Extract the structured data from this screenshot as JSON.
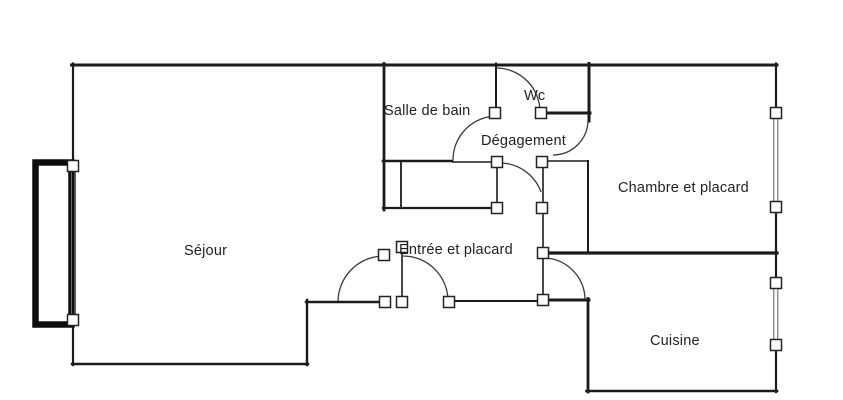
{
  "floorplan": {
    "type_label": "apartment-floor-plan",
    "colors": {
      "background": "#ffffff",
      "wall": "#1b1b1b",
      "door_arc": "#3a3a3a",
      "text": "#1f1f1f"
    },
    "rooms": {
      "sejour": {
        "label": "Séjour"
      },
      "salle_de_bain": {
        "label": "Salle de bain"
      },
      "wc": {
        "label": "Wc"
      },
      "degagement": {
        "label": "Dégagement"
      },
      "entree": {
        "label": "Entrée et placard"
      },
      "chambre": {
        "label": "Chambre et placard"
      },
      "cuisine": {
        "label": "Cuisine"
      }
    }
  }
}
